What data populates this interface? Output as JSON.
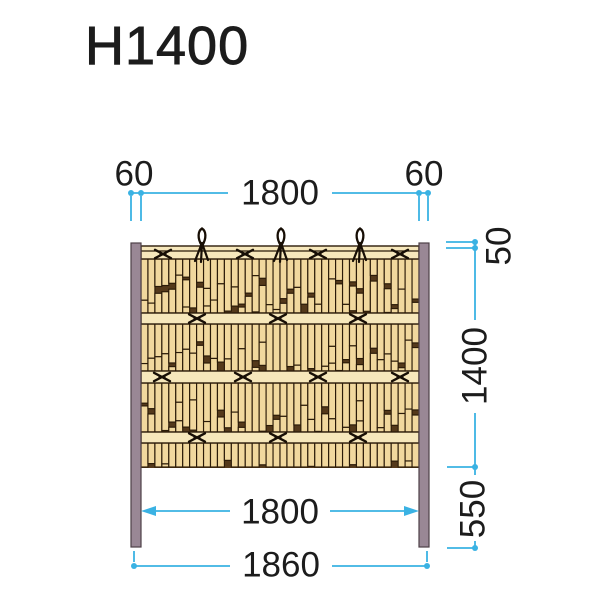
{
  "title": "H1400",
  "dimensions": {
    "top_left_post_width": "60",
    "top_span": "1800",
    "top_right_post_width": "60",
    "right_top_offset": "50",
    "right_panel_height": "1400",
    "right_ground_clearance": "550",
    "bottom_inner_span": "1800",
    "bottom_overall_width": "1860"
  },
  "colors": {
    "dimension_line": "#3ab2e3",
    "text": "#1c1c1c",
    "post_fill": "#998795",
    "post_stroke": "#4d3f47",
    "slat_fill": "#f1d89e",
    "rail_fill": "#f6e7bb",
    "outline": "#2b1b08",
    "gap_fill": "#54391b",
    "rope": "#170e05",
    "background": "#ffffff"
  },
  "figure": {
    "description": "Bamboo fence panel (Kenninji style) with two square posts, four horizontal rails, vertical bamboo slats, black rope cross ties and three decorative top knots",
    "panel": {
      "left": 141,
      "right": 419,
      "top": 246,
      "bottom": 467
    },
    "top_band": {
      "top": 246,
      "bottom": 259,
      "cap_line_y": 251
    },
    "rails_y": [
      [
        313,
        324
      ],
      [
        371,
        383
      ],
      [
        432,
        443
      ]
    ],
    "slat_rows": [
      [
        259,
        313
      ],
      [
        324,
        371
      ],
      [
        383,
        432
      ],
      [
        443,
        467
      ]
    ],
    "slat_pitch": 6.95,
    "ties": [
      {
        "y": 254,
        "xs": [
          163,
          245,
          318,
          400
        ]
      },
      {
        "y": 318.5,
        "xs": [
          197,
          278,
          358
        ]
      },
      {
        "y": 377,
        "xs": [
          162,
          243,
          318,
          400
        ]
      },
      {
        "y": 437.5,
        "xs": [
          197,
          278,
          358
        ]
      }
    ],
    "knots_x": [
      202,
      281,
      360
    ],
    "posts": [
      {
        "x": 131,
        "y": 243,
        "w": 10,
        "h": 304
      },
      {
        "x": 419,
        "y": 243,
        "w": 10,
        "h": 304
      }
    ]
  }
}
